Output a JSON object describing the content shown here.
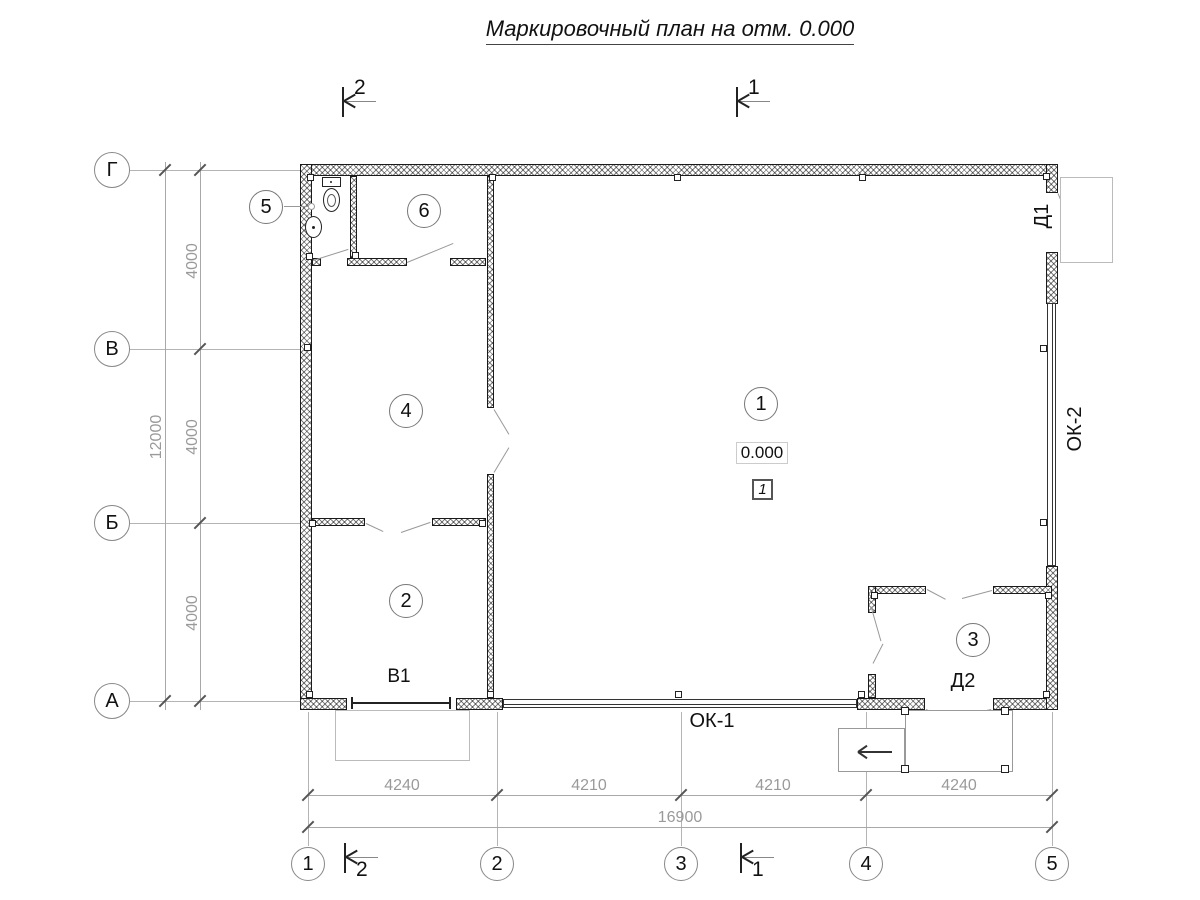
{
  "title": "Маркировочный план на отм. 0.000",
  "axes": {
    "rows": [
      "Г",
      "В",
      "Б",
      "А"
    ],
    "cols": [
      "1",
      "2",
      "3",
      "4",
      "5"
    ]
  },
  "dims": {
    "left": [
      "4000",
      "4000",
      "4000"
    ],
    "left_total": "12000",
    "bottom": [
      "4240",
      "4210",
      "4210",
      "4240"
    ],
    "bottom_total": "16900"
  },
  "sections": {
    "cut1": "1",
    "cut2": "2"
  },
  "rooms": {
    "r1": "1",
    "r2": "2",
    "r3": "3",
    "r4": "4",
    "r5": "5",
    "r6": "6"
  },
  "marks": {
    "gate": "В1",
    "window1": "ОК-1",
    "window2": "ОК-2",
    "door1": "Д1",
    "door2": "Д2",
    "level": "0.000",
    "zone": "1"
  }
}
